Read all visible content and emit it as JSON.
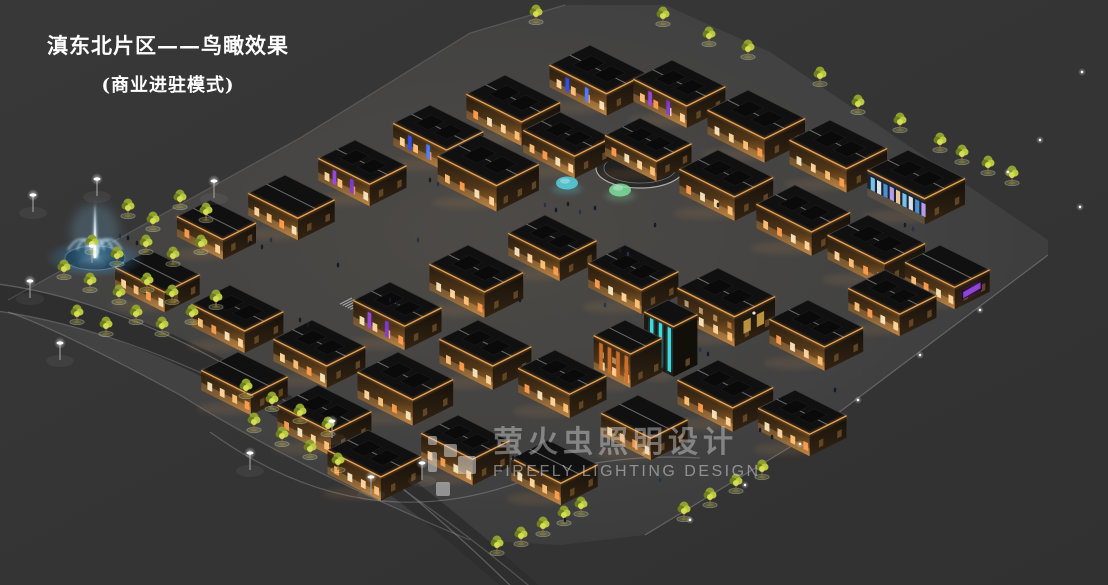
{
  "page": {
    "title_line1": "滇东北片区——鸟瞰效果",
    "title_line2": "(商业进驻模式)"
  },
  "watermark": {
    "cn": "萤火虫照明设计",
    "en": "FIREFLY LIGHTING DESIGN"
  },
  "colors": {
    "background": "#343434",
    "plaza": "#424242",
    "roof": "#101010",
    "eave_light": "#f2a854",
    "warm_window": "#ffc379",
    "neon_purple": "#9a4ae0",
    "neon_blue": "#3a5cff",
    "neon_cyan": "#3fe3ea",
    "neon_orange": "#cc6f2a",
    "screen_purple": "#8a2fd8",
    "fountain_blue": "#7fc8f0",
    "tree_green": "#b9c83f",
    "title_text": "#ffffff",
    "watermark_gray": "#d8d8d8"
  },
  "scene": {
    "palette": {
      "win": [
        "#ffd9a0",
        "#ffc379",
        "#ff9e4f",
        "#f7e7c0"
      ],
      "winDim": "#6b4e28",
      "eave": "#f2a854",
      "banner_purple": [
        "#9a4ae0",
        "#7f3ad0"
      ],
      "banner_blue": [
        "#2d52f0",
        "#4a7cff"
      ],
      "glass": [
        "#7fd4ff",
        "#eef6ff",
        "#4f9de0",
        "#c9a8ff",
        "#ffd9a0"
      ],
      "screen": "#9a4ae0",
      "cyan": "#3fe3ea",
      "orange": "#cc6f2a",
      "poster": "#c9a045",
      "treeGreens": [
        "#8fa02e",
        "#6e7f22",
        "#b9c83f",
        "#d4de55"
      ],
      "trunk": "#8a653a",
      "people": [
        "#10182e",
        "#1b1b1b",
        "#27304f"
      ]
    },
    "buildings": [
      [
        505,
        75,
        60,
        42,
        24,
        "warm"
      ],
      [
        590,
        45,
        62,
        44,
        22,
        "blue"
      ],
      [
        672,
        60,
        58,
        42,
        22,
        "purple"
      ],
      [
        748,
        90,
        62,
        44,
        24,
        "warm"
      ],
      [
        830,
        120,
        62,
        44,
        24,
        "warm"
      ],
      [
        908,
        150,
        62,
        44,
        26,
        "glass"
      ],
      [
        430,
        105,
        58,
        40,
        22,
        "blue"
      ],
      [
        355,
        140,
        56,
        40,
        22,
        "purple"
      ],
      [
        285,
        175,
        54,
        40,
        22,
        "warm"
      ],
      [
        210,
        200,
        50,
        36,
        20,
        "warm"
      ],
      [
        480,
        135,
        64,
        46,
        26,
        "warm"
      ],
      [
        560,
        112,
        56,
        40,
        22,
        "warm"
      ],
      [
        640,
        118,
        56,
        38,
        20,
        "warm"
      ],
      [
        718,
        150,
        60,
        42,
        24,
        "warm"
      ],
      [
        795,
        185,
        60,
        42,
        24,
        "warm"
      ],
      [
        868,
        215,
        62,
        44,
        24,
        "warm"
      ],
      [
        940,
        245,
        54,
        38,
        22,
        "screen"
      ],
      [
        150,
        250,
        54,
        38,
        20,
        "warm"
      ],
      [
        230,
        285,
        58,
        42,
        22,
        "warm"
      ],
      [
        312,
        320,
        58,
        42,
        22,
        "warm"
      ],
      [
        390,
        282,
        56,
        40,
        24,
        "purple"
      ],
      [
        468,
        245,
        60,
        42,
        26,
        "warm"
      ],
      [
        545,
        215,
        56,
        40,
        22,
        "warm"
      ],
      [
        625,
        245,
        58,
        40,
        24,
        "warm"
      ],
      [
        668,
        300,
        32,
        26,
        50,
        "tower"
      ],
      [
        718,
        268,
        62,
        44,
        30,
        "poster"
      ],
      [
        808,
        300,
        60,
        42,
        24,
        "warm"
      ],
      [
        885,
        270,
        56,
        40,
        22,
        "warm"
      ],
      [
        238,
        352,
        54,
        40,
        20,
        "warm"
      ],
      [
        318,
        385,
        58,
        44,
        24,
        "warm"
      ],
      [
        398,
        352,
        60,
        44,
        26,
        "warm"
      ],
      [
        478,
        320,
        58,
        42,
        24,
        "warm"
      ],
      [
        555,
        350,
        56,
        40,
        24,
        "warm"
      ],
      [
        625,
        320,
        40,
        34,
        34,
        "orange"
      ],
      [
        638,
        395,
        54,
        40,
        22,
        "warm"
      ],
      [
        718,
        360,
        60,
        44,
        24,
        "warm"
      ],
      [
        795,
        390,
        56,
        40,
        22,
        "warm"
      ],
      [
        368,
        430,
        58,
        44,
        24,
        "warm"
      ],
      [
        458,
        415,
        56,
        40,
        26,
        "warm"
      ],
      [
        548,
        440,
        54,
        40,
        22,
        "warm"
      ]
    ],
    "trees": [
      [
        128,
        216
      ],
      [
        153,
        229
      ],
      [
        180,
        207
      ],
      [
        206,
        220
      ],
      [
        92,
        252
      ],
      [
        117,
        264
      ],
      [
        146,
        252
      ],
      [
        173,
        264
      ],
      [
        201,
        252
      ],
      [
        64,
        277
      ],
      [
        90,
        290
      ],
      [
        119,
        302
      ],
      [
        147,
        290
      ],
      [
        172,
        302
      ],
      [
        77,
        322
      ],
      [
        106,
        334
      ],
      [
        136,
        322
      ],
      [
        162,
        334
      ],
      [
        192,
        322
      ],
      [
        216,
        307
      ],
      [
        246,
        396
      ],
      [
        272,
        409
      ],
      [
        300,
        421
      ],
      [
        328,
        434
      ],
      [
        254,
        430
      ],
      [
        282,
        444
      ],
      [
        310,
        457
      ],
      [
        338,
        470
      ],
      [
        497,
        553
      ],
      [
        521,
        544
      ],
      [
        543,
        534
      ],
      [
        564,
        523
      ],
      [
        581,
        514
      ],
      [
        684,
        519
      ],
      [
        710,
        505
      ],
      [
        736,
        491
      ],
      [
        762,
        477
      ],
      [
        536,
        22
      ],
      [
        663,
        24
      ],
      [
        709,
        44
      ],
      [
        748,
        57
      ],
      [
        820,
        84
      ],
      [
        858,
        112
      ],
      [
        900,
        130
      ],
      [
        940,
        150
      ],
      [
        962,
        162
      ],
      [
        988,
        173
      ],
      [
        1012,
        183
      ]
    ],
    "lamps": [
      [
        33,
        212
      ],
      [
        97,
        196
      ],
      [
        92,
        263
      ],
      [
        30,
        298
      ],
      [
        214,
        198
      ],
      [
        332,
        438
      ],
      [
        371,
        494
      ],
      [
        422,
        480
      ],
      [
        60,
        360
      ],
      [
        250,
        470
      ]
    ],
    "bollards": [
      [
        1082,
        72
      ],
      [
        1040,
        140
      ],
      [
        1080,
        207
      ],
      [
        1008,
        172
      ],
      [
        980,
        310
      ],
      [
        920,
        355
      ],
      [
        858,
        400
      ],
      [
        800,
        444
      ],
      [
        745,
        485
      ],
      [
        690,
        520
      ]
    ],
    "people": [
      [
        250,
        243
      ],
      [
        262,
        247
      ],
      [
        271,
        240
      ],
      [
        128,
        238
      ],
      [
        137,
        243
      ],
      [
        120,
        236
      ],
      [
        390,
        300
      ],
      [
        397,
        304
      ],
      [
        545,
        205
      ],
      [
        556,
        210
      ],
      [
        568,
        204
      ],
      [
        580,
        212
      ],
      [
        595,
        208
      ],
      [
        620,
        250
      ],
      [
        628,
        254
      ],
      [
        475,
        455
      ],
      [
        487,
        462
      ],
      [
        500,
        470
      ],
      [
        513,
        458
      ],
      [
        527,
        466
      ],
      [
        540,
        474
      ],
      [
        300,
        320
      ],
      [
        308,
        325
      ],
      [
        700,
        350
      ],
      [
        708,
        354
      ],
      [
        905,
        225
      ],
      [
        913,
        229
      ],
      [
        760,
        430
      ],
      [
        772,
        437
      ],
      [
        660,
        480
      ],
      [
        565,
        520
      ],
      [
        430,
        180
      ],
      [
        438,
        184
      ],
      [
        835,
        390
      ],
      [
        520,
        300
      ],
      [
        605,
        305
      ],
      [
        655,
        225
      ],
      [
        718,
        205
      ],
      [
        418,
        240
      ],
      [
        338,
        265
      ]
    ],
    "domes": [
      [
        567,
        186,
        "#56d9e8"
      ],
      [
        620,
        193,
        "#7fe6a0"
      ]
    ],
    "fountain": {
      "x": 95,
      "y": 250
    },
    "rink": {
      "cx": 640,
      "cy": 168,
      "rx": 44,
      "ry": 20
    },
    "stairs": [
      [
        352,
        298,
        6,
        22
      ],
      [
        452,
        258,
        5,
        10
      ]
    ]
  }
}
